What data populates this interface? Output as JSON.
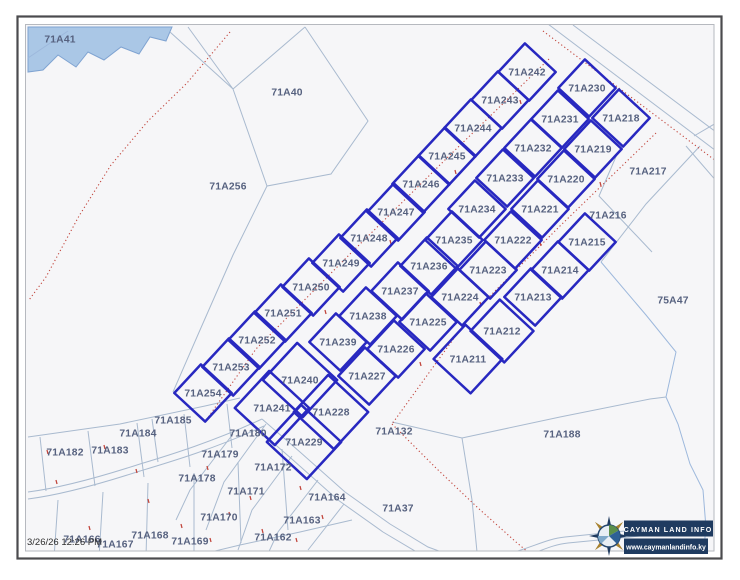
{
  "map": {
    "timestamp": "3/26/26 12:26 PM",
    "logo": {
      "name": "CAYMAN LAND INFO",
      "url": "www.caymanlandinfo.ky"
    },
    "colors": {
      "map_bg": "#f6f6f8",
      "parcel_bold": "#2828c0",
      "parcel_thin": "#a9bacf",
      "label": "#56617f",
      "road_dots": "#c2473e",
      "water_fill": "#aac7e6",
      "water_stroke": "#7fa3d1",
      "logo_bar": "#1f3b60",
      "frame_outer": "#4b4b4e",
      "frame_inner": "#b6b9bf"
    },
    "bold_parcels": [
      {
        "id": "71A242",
        "x": 527,
        "y": 72
      },
      {
        "id": "71A243",
        "x": 500,
        "y": 100
      },
      {
        "id": "71A244",
        "x": 473,
        "y": 128
      },
      {
        "id": "71A245",
        "x": 447,
        "y": 156
      },
      {
        "id": "71A246",
        "x": 421,
        "y": 184
      },
      {
        "id": "71A247",
        "x": 396,
        "y": 212
      },
      {
        "id": "71A248",
        "x": 369,
        "y": 238
      },
      {
        "id": "71A249",
        "x": 341,
        "y": 263
      },
      {
        "id": "71A250",
        "x": 311,
        "y": 287
      },
      {
        "id": "71A251",
        "x": 283,
        "y": 313
      },
      {
        "id": "71A252",
        "x": 257,
        "y": 340
      },
      {
        "id": "71A253",
        "x": 231,
        "y": 367
      },
      {
        "id": "71A254",
        "x": 203,
        "y": 393
      },
      {
        "id": "71A230",
        "x": 587,
        "y": 88
      },
      {
        "id": "71A231",
        "x": 560,
        "y": 119
      },
      {
        "id": "71A232",
        "x": 533,
        "y": 148
      },
      {
        "id": "71A233",
        "x": 505,
        "y": 178
      },
      {
        "id": "71A234",
        "x": 477,
        "y": 209
      },
      {
        "id": "71A235",
        "x": 454,
        "y": 240
      },
      {
        "id": "71A236",
        "x": 429,
        "y": 266
      },
      {
        "id": "71A237",
        "x": 400,
        "y": 291
      },
      {
        "id": "71A238",
        "x": 368,
        "y": 316
      },
      {
        "id": "71A239",
        "x": 338,
        "y": 342
      },
      {
        "id": "71A240",
        "x": 300,
        "y": 380,
        "s": 1.3
      },
      {
        "id": "71A241",
        "x": 272,
        "y": 408,
        "s": 1.3
      },
      {
        "id": "71A218",
        "x": 621,
        "y": 118
      },
      {
        "id": "71A219",
        "x": 593,
        "y": 149
      },
      {
        "id": "71A220",
        "x": 566,
        "y": 179
      },
      {
        "id": "71A221",
        "x": 540,
        "y": 209
      },
      {
        "id": "71A222",
        "x": 513,
        "y": 240
      },
      {
        "id": "71A223",
        "x": 488,
        "y": 270
      },
      {
        "id": "71A224",
        "x": 460,
        "y": 297
      },
      {
        "id": "71A225",
        "x": 428,
        "y": 322
      },
      {
        "id": "71A226",
        "x": 396,
        "y": 349
      },
      {
        "id": "71A227",
        "x": 367,
        "y": 376
      },
      {
        "id": "71A228",
        "x": 331,
        "y": 412,
        "s": 1.3
      },
      {
        "id": "71A229",
        "x": 304,
        "y": 442,
        "s": 1.3
      },
      {
        "id": "71A215",
        "x": 587,
        "y": 242
      },
      {
        "id": "71A214",
        "x": 560,
        "y": 270
      },
      {
        "id": "71A213",
        "x": 533,
        "y": 297
      },
      {
        "id": "71A212",
        "x": 502,
        "y": 331,
        "s": 1.1
      },
      {
        "id": "71A211",
        "x": 468,
        "y": 359,
        "s": 1.2
      }
    ],
    "thin_parcels": [
      {
        "id": "71A41",
        "x": 60,
        "y": 39
      },
      {
        "id": "71A40",
        "x": 287,
        "y": 92
      },
      {
        "id": "71A256",
        "x": 228,
        "y": 186
      },
      {
        "id": "71A217",
        "x": 648,
        "y": 171
      },
      {
        "id": "71A216",
        "x": 608,
        "y": 215
      },
      {
        "id": "75A47",
        "x": 673,
        "y": 300
      },
      {
        "id": "71A132",
        "x": 394,
        "y": 431
      },
      {
        "id": "71A188",
        "x": 562,
        "y": 434
      },
      {
        "id": "71A37",
        "x": 398,
        "y": 508
      },
      {
        "id": "71A185",
        "x": 173,
        "y": 420
      },
      {
        "id": "71A184",
        "x": 138,
        "y": 433
      },
      {
        "id": "71A183",
        "x": 110,
        "y": 450
      },
      {
        "id": "71A182",
        "x": 65,
        "y": 452
      },
      {
        "id": "71A180",
        "x": 248,
        "y": 433
      },
      {
        "id": "71A179",
        "x": 220,
        "y": 454
      },
      {
        "id": "71A178",
        "x": 197,
        "y": 478
      },
      {
        "id": "71A172",
        "x": 273,
        "y": 467
      },
      {
        "id": "71A171",
        "x": 246,
        "y": 491
      },
      {
        "id": "71A170",
        "x": 219,
        "y": 517
      },
      {
        "id": "71A164",
        "x": 327,
        "y": 497
      },
      {
        "id": "71A163",
        "x": 302,
        "y": 520
      },
      {
        "id": "71A162",
        "x": 273,
        "y": 537
      },
      {
        "id": "71A166",
        "x": 82,
        "y": 539
      },
      {
        "id": "71A167",
        "x": 115,
        "y": 544
      },
      {
        "id": "71A168",
        "x": 150,
        "y": 535
      },
      {
        "id": "71A169",
        "x": 190,
        "y": 541
      }
    ]
  }
}
